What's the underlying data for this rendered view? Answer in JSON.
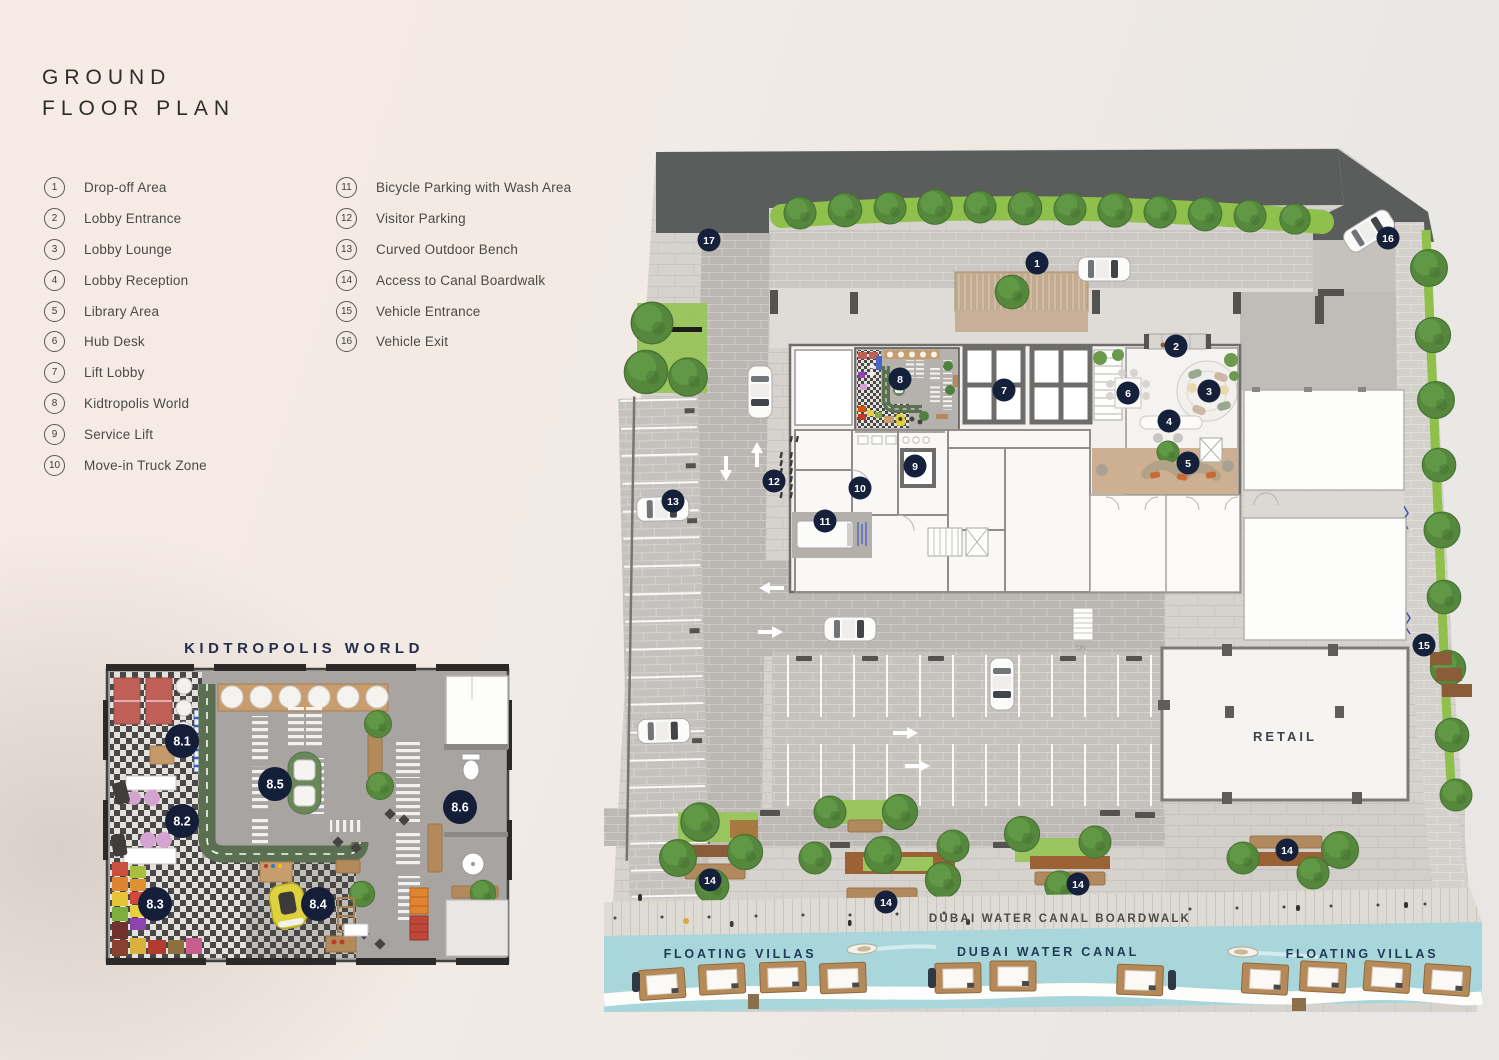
{
  "header": {
    "line1": "GROUND",
    "line2": "FLOOR PLAN"
  },
  "legend": {
    "items": [
      {
        "num": "1",
        "label": "Drop-off Area"
      },
      {
        "num": "2",
        "label": "Lobby Entrance"
      },
      {
        "num": "3",
        "label": "Lobby Lounge"
      },
      {
        "num": "4",
        "label": "Lobby Reception"
      },
      {
        "num": "5",
        "label": "Library Area"
      },
      {
        "num": "6",
        "label": "Hub Desk"
      },
      {
        "num": "7",
        "label": "Lift Lobby"
      },
      {
        "num": "8",
        "label": "Kidtropolis World"
      },
      {
        "num": "9",
        "label": "Service Lift"
      },
      {
        "num": "10",
        "label": "Move-in Truck Zone"
      },
      {
        "num": "11",
        "label": "Bicycle Parking with Wash Area"
      },
      {
        "num": "12",
        "label": "Visitor Parking"
      },
      {
        "num": "13",
        "label": "Curved Outdoor Bench"
      },
      {
        "num": "14",
        "label": "Access to Canal Boardwalk"
      },
      {
        "num": "15",
        "label": "Vehicle Entrance"
      },
      {
        "num": "16",
        "label": "Vehicle Exit"
      }
    ]
  },
  "inset": {
    "title": "KIDTROPOLIS WORLD",
    "badges": [
      {
        "label": "8.1"
      },
      {
        "label": "8.2"
      },
      {
        "label": "8.3"
      },
      {
        "label": "8.4"
      },
      {
        "label": "8.5"
      },
      {
        "label": "8.6"
      }
    ]
  },
  "plan": {
    "badges": [
      {
        "label": "1"
      },
      {
        "label": "2"
      },
      {
        "label": "3"
      },
      {
        "label": "4"
      },
      {
        "label": "5"
      },
      {
        "label": "6"
      },
      {
        "label": "7"
      },
      {
        "label": "8"
      },
      {
        "label": "9"
      },
      {
        "label": "10"
      },
      {
        "label": "11"
      },
      {
        "label": "12"
      },
      {
        "label": "13"
      },
      {
        "label": "14"
      },
      {
        "label": "14"
      },
      {
        "label": "14"
      },
      {
        "label": "14"
      },
      {
        "label": "15"
      },
      {
        "label": "16"
      },
      {
        "label": "17"
      }
    ],
    "labels": {
      "retail": "RETAIL",
      "boardwalk": "DUBAI WATER CANAL BOARDWALK",
      "canal": "DUBAI WATER CANAL",
      "floating_villas_left": "FLOATING VILLAS",
      "floating_villas_right": "FLOATING VILLAS",
      "stair_dn": "DN"
    },
    "colors": {
      "badge_navy": "#15203b",
      "label_navy": "#1f3a57",
      "hedge_green": "#8fc04c",
      "tree_green": "#55883c",
      "road_dark": "#5a5d5c",
      "canal_water": "#a9d6da",
      "wood": "#c79d6e",
      "pavement": "#d6d3cf"
    }
  }
}
